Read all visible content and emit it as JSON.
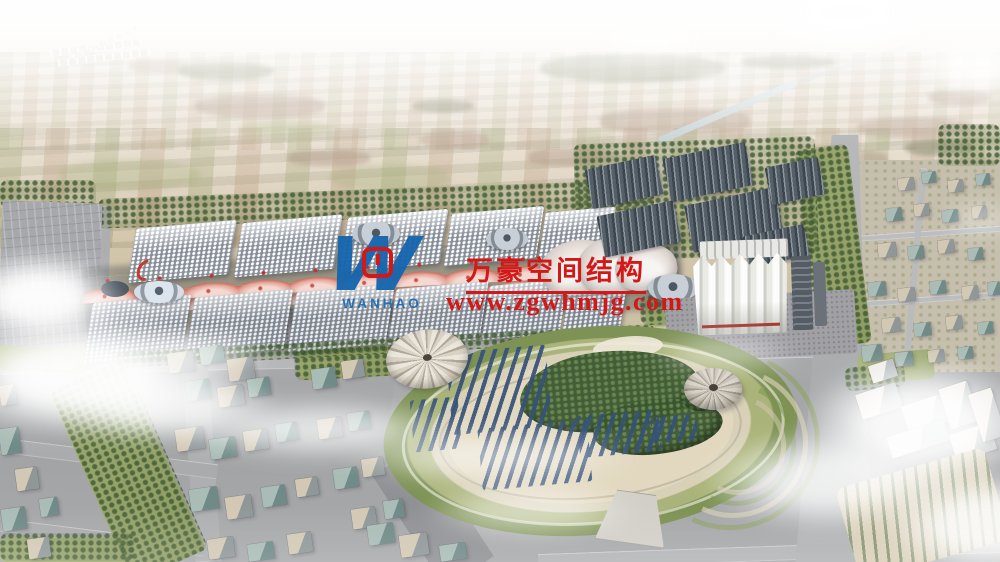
{
  "watermark": {
    "company_name_cn": "万豪空间结构",
    "website_url": "www.zgwhmjg.com",
    "logo_monogram": "W",
    "logo_latin_text": "WANHAO",
    "red": "#d21818",
    "blue": "#1766ae"
  },
  "scene": {
    "subject": "Aerial architectural rendering of a large exhibition and convention complex with wave-shaped pink canopies, warehouse district, central landscaped park with solar arrays, and surrounding city blocks fading into hazy farmland",
    "palette": {
      "sky_haze": "#f4f2ec",
      "farmland": "#cfc3a8",
      "trees": "#4c6a40",
      "roads": "#b0b1b4",
      "hall_roof": "#e8ebef",
      "canopy_pink": "#c9705f",
      "warehouse_roof": "#555f68",
      "park_ground": "#e2d8bf",
      "solar_panel": "#34517b",
      "building_tan": "#d2c8b4",
      "building_glass": "#a9bcb6",
      "cloud": "#ffffff"
    }
  }
}
